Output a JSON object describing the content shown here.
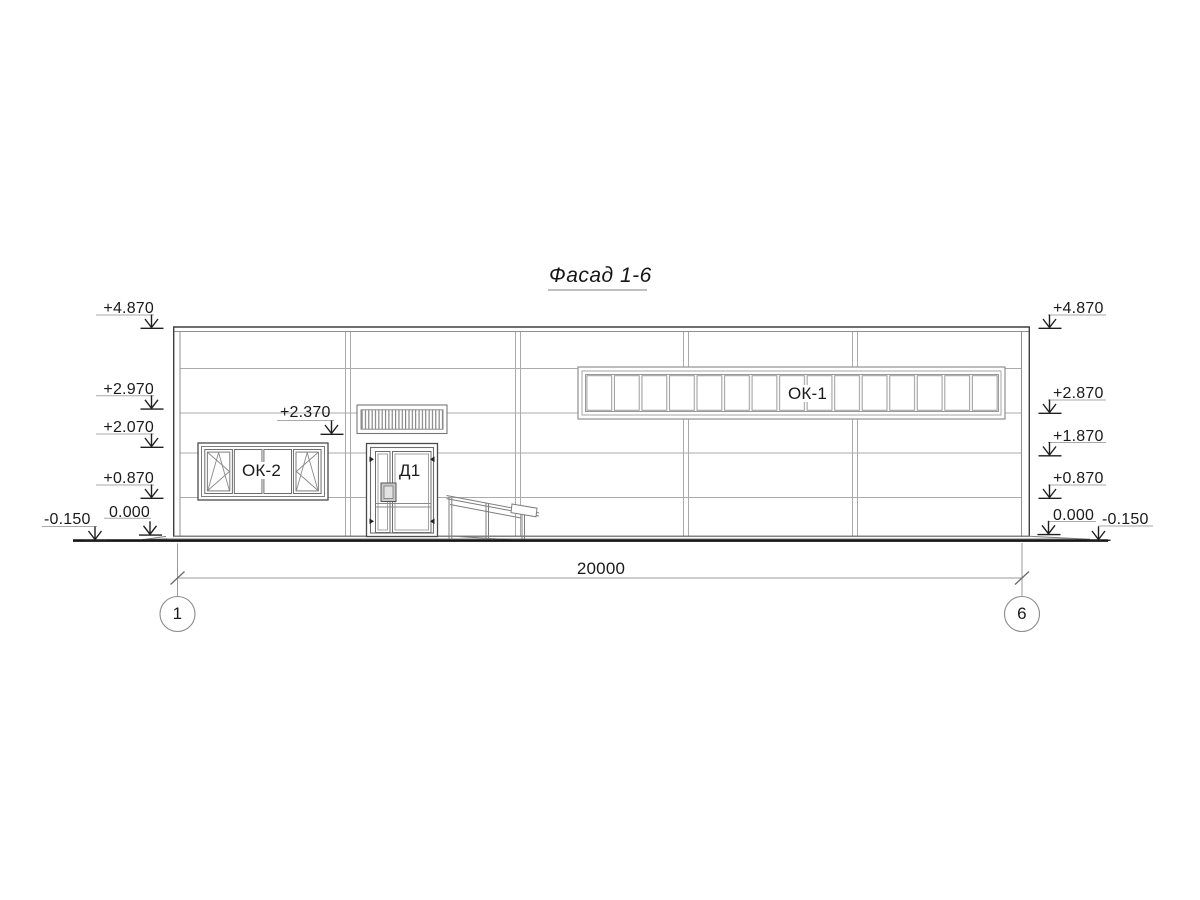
{
  "sheet": {
    "title": "Фасад 1-6"
  },
  "elevation_marks": {
    "left": [
      {
        "value": "+4.870"
      },
      {
        "value": "+2.970"
      },
      {
        "value": "+2.070"
      },
      {
        "value": "+0.870"
      },
      {
        "value": "0.000"
      },
      {
        "value": "-0.150"
      }
    ],
    "right": [
      {
        "value": "+4.870"
      },
      {
        "value": "+2.870"
      },
      {
        "value": "+1.870"
      },
      {
        "value": "+0.870"
      },
      {
        "value": "0.000"
      },
      {
        "value": "-0.150"
      }
    ],
    "entrance_canopy": {
      "value": "+2.370"
    }
  },
  "component_tags": {
    "ribbon_window": "ОК-1",
    "entrance_window": "ОК-2",
    "entrance_door": "Д1"
  },
  "dimension": {
    "overall": "20000"
  },
  "grid_axes": {
    "first": "1",
    "last": "6"
  },
  "colors": {
    "paper": "#ffffff",
    "outline": "#3f3f3f",
    "secondary_line": "#8f8f8f",
    "panel_joint": "#ababab",
    "ground": "#161616",
    "text": "#1a1a1a"
  }
}
